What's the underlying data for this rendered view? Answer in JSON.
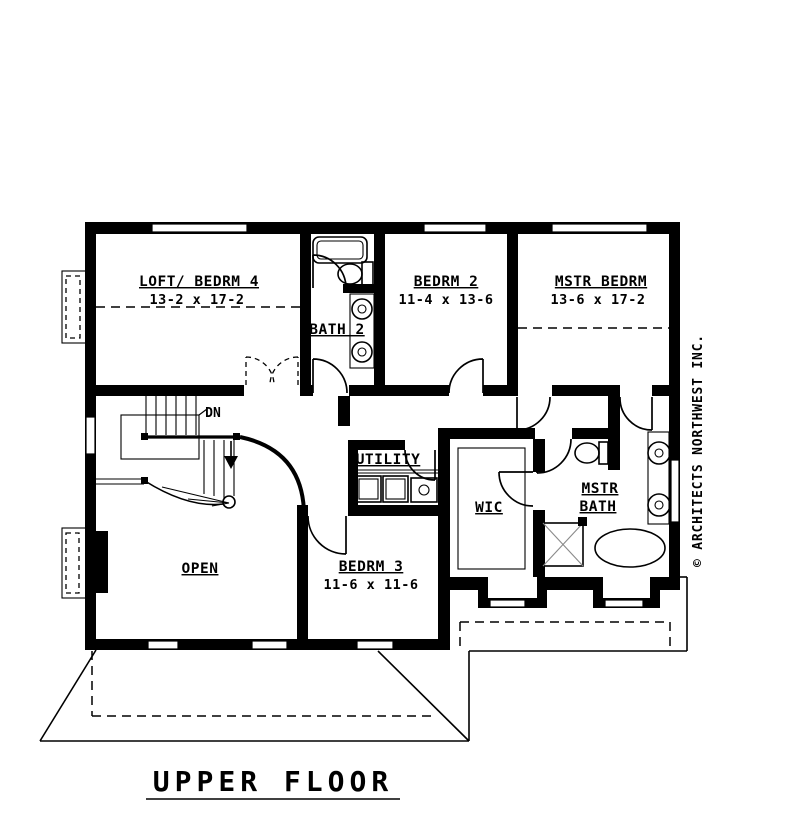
{
  "drawing_title": "UPPER FLOOR",
  "copyright_text": "© ARCHITECTS NORTHWEST INC.",
  "stairs": {
    "direction_label": "DN"
  },
  "rooms": {
    "loft_bedrm4": {
      "name": "LOFT/ BEDRM 4",
      "dims": "13-2 x 17-2"
    },
    "bath2": {
      "name": "BATH 2"
    },
    "bedrm2": {
      "name": "BEDRM 2",
      "dims": "11-4 x 13-6"
    },
    "mstr_bedrm": {
      "name": "MSTR BEDRM",
      "dims": "13-6 x 17-2"
    },
    "utility": {
      "name": "UTILITY"
    },
    "wic": {
      "name": "WIC"
    },
    "mstr_bath": {
      "name_line1": "MSTR",
      "name_line2": "BATH"
    },
    "bedrm3": {
      "name": "BEDRM 3",
      "dims": "11-6  x 11-6"
    },
    "open_below": {
      "name": "OPEN"
    }
  },
  "colors": {
    "line": "#000000",
    "background": "#ffffff"
  }
}
